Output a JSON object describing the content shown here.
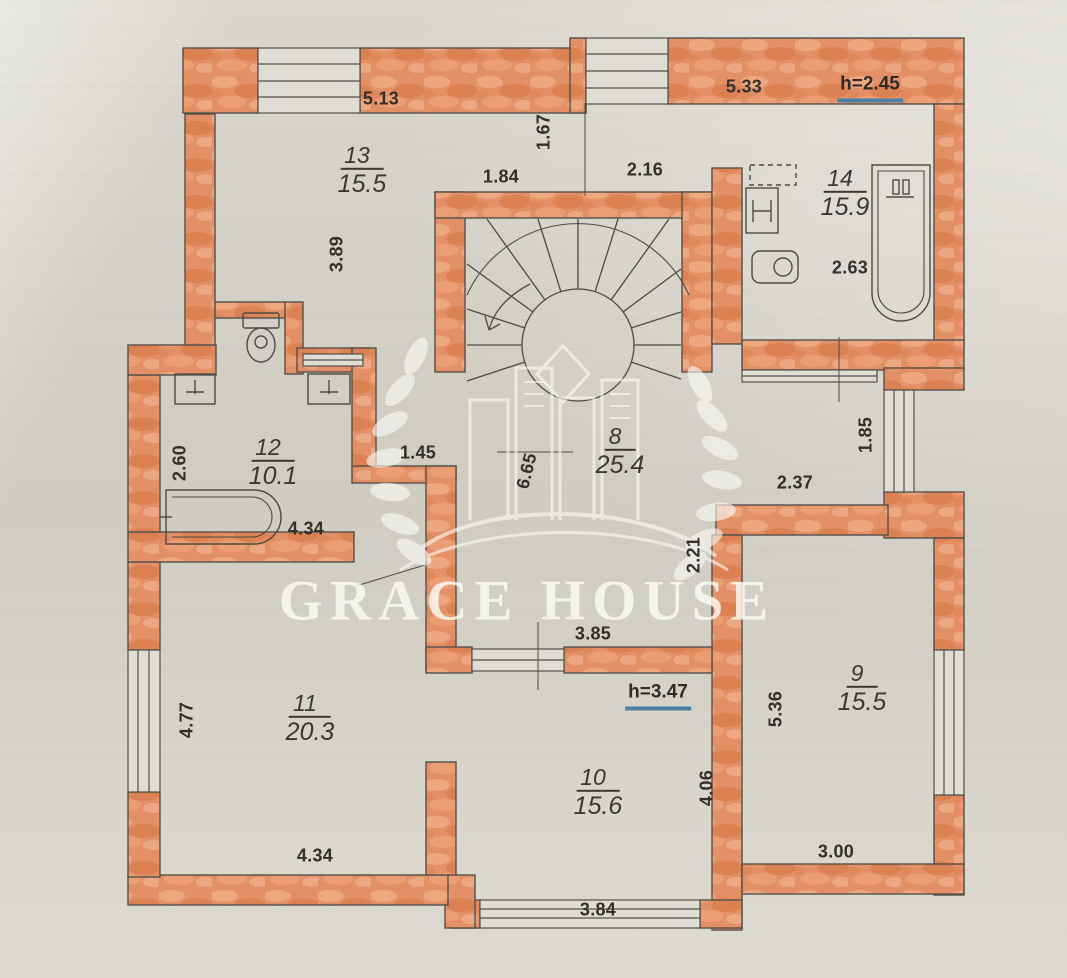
{
  "watermark": {
    "text": "GRACE HOUSE"
  },
  "rooms": {
    "r8": {
      "number": "8",
      "area": "25.4"
    },
    "r9": {
      "number": "9",
      "area": "15.5"
    },
    "r10": {
      "number": "10",
      "area": "15.6"
    },
    "r11": {
      "number": "11",
      "area": "20.3"
    },
    "r12": {
      "number": "12",
      "area": "10.1"
    },
    "r13": {
      "number": "13",
      "area": "15.5"
    },
    "r14": {
      "number": "14",
      "area": "15.9"
    }
  },
  "heights": {
    "h1": "h=2.45",
    "h2": "h=3.47"
  },
  "dims": {
    "d513": "5.13",
    "d167": "1.67",
    "d184": "1.84",
    "d216": "2.16",
    "d533": "5.33",
    "d263": "2.63",
    "d389": "3.89",
    "d260": "2.60",
    "d434a": "4.34",
    "d145": "1.45",
    "d665": "6.65",
    "d185": "1.85",
    "d237": "2.37",
    "d221": "2.21",
    "d477": "4.77",
    "d434b": "4.34",
    "d385": "3.85",
    "d536": "5.36",
    "d406": "4.06",
    "d384": "3.84",
    "d300": "3.00"
  }
}
